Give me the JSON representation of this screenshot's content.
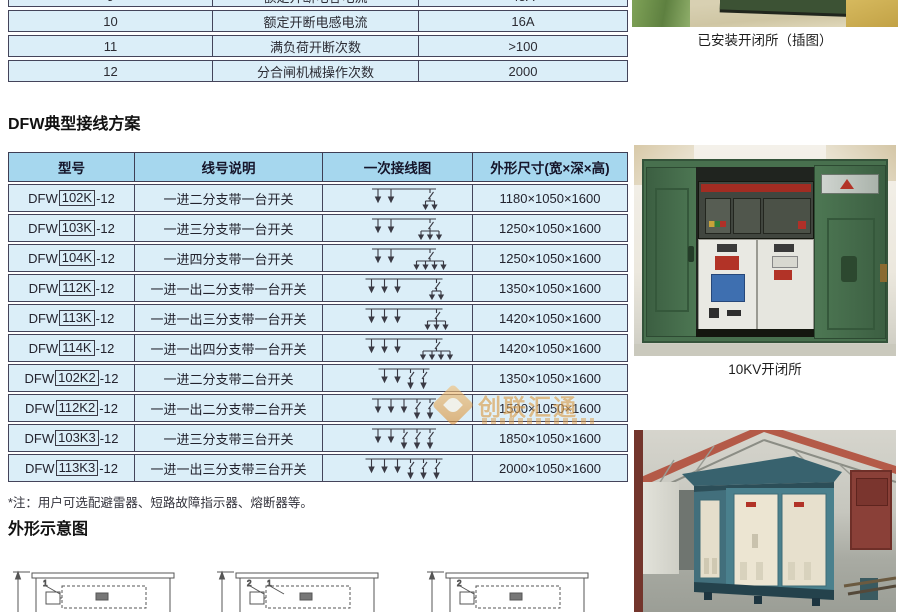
{
  "spec_table": {
    "rows": [
      {
        "no": "9",
        "name": "额定开断电容电流",
        "value": "45A"
      },
      {
        "no": "10",
        "name": "额定开断电感电流",
        "value": "16A"
      },
      {
        "no": "11",
        "name": "满负荷开断次数",
        "value": ">100"
      },
      {
        "no": "12",
        "name": "分合闸机械操作次数",
        "value": "2000"
      }
    ]
  },
  "scheme": {
    "title": "DFW典型接线方案",
    "headers": [
      "型号",
      "线号说明",
      "一次接线图",
      "外形尺寸(宽×深×高)"
    ],
    "rows": [
      {
        "prefix": "DFW",
        "box": "102K",
        "suffix": "-12",
        "desc": "一进二分支带一台开关",
        "size": "1180×1050×1600",
        "diagram": {
          "plain": 2,
          "switches": 1,
          "sub": 2
        }
      },
      {
        "prefix": "DFW",
        "box": "103K",
        "suffix": "-12",
        "desc": "一进三分支带一台开关",
        "size": "1250×1050×1600",
        "diagram": {
          "plain": 2,
          "switches": 1,
          "sub": 3
        }
      },
      {
        "prefix": "DFW",
        "box": "104K",
        "suffix": "-12",
        "desc": "一进四分支带一台开关",
        "size": "1250×1050×1600",
        "diagram": {
          "plain": 2,
          "switches": 1,
          "sub": 4
        }
      },
      {
        "prefix": "DFW",
        "box": "112K",
        "suffix": "-12",
        "desc": "一进一出二分支带一台开关",
        "size": "1350×1050×1600",
        "diagram": {
          "plain": 3,
          "switches": 1,
          "sub": 2
        }
      },
      {
        "prefix": "DFW",
        "box": "113K",
        "suffix": "-12",
        "desc": "一进一出三分支带一台开关",
        "size": "1420×1050×1600",
        "diagram": {
          "plain": 3,
          "switches": 1,
          "sub": 3
        }
      },
      {
        "prefix": "DFW",
        "box": "114K",
        "suffix": "-12",
        "desc": "一进一出四分支带一台开关",
        "size": "1420×1050×1600",
        "diagram": {
          "plain": 3,
          "switches": 1,
          "sub": 4
        }
      },
      {
        "prefix": "DFW",
        "box": "102K2",
        "suffix": " -12",
        "desc": "一进二分支带二台开关",
        "size": "1350×1050×1600",
        "diagram": {
          "plain": 2,
          "switches": 2,
          "sub": 0
        }
      },
      {
        "prefix": "DFW",
        "box": "112K2",
        "suffix": " -12",
        "desc": "一进一出二分支带二台开关",
        "size": "1500×1050×1600",
        "diagram": {
          "plain": 3,
          "switches": 2,
          "sub": 0
        }
      },
      {
        "prefix": "DFW",
        "box": "103K3",
        "suffix": " -12",
        "desc": "一进三分支带三台开关",
        "size": "1850×1050×1600",
        "diagram": {
          "plain": 2,
          "switches": 3,
          "sub": 0
        }
      },
      {
        "prefix": "DFW",
        "box": "113K3",
        "suffix": " -12",
        "desc": "一进一出三分支带三台开关",
        "size": "2000×1050×1600",
        "diagram": {
          "plain": 3,
          "switches": 3,
          "sub": 0
        }
      }
    ]
  },
  "note": "*注：用户可选配避雷器、短路故障指示器、熔断器等。",
  "outline": {
    "title": "外形示意图",
    "drawings": [
      {
        "labels": [
          "1"
        ]
      },
      {
        "labels": [
          "2",
          "1"
        ]
      },
      {
        "labels": [
          "2"
        ]
      }
    ]
  },
  "right_column": {
    "caption_installed": "已安装开闭所（插图）",
    "caption_10kv": "10KV开闭所"
  },
  "watermark": {
    "text": "创联汇通"
  },
  "colors": {
    "header_bg": "#a6d7ee",
    "cell_bg": "#dbeef8",
    "border": "#44445a",
    "watermark_orange": "#dd9c46",
    "cabinet_green": "#4a7350",
    "substation_teal": "#4a7f8c"
  }
}
